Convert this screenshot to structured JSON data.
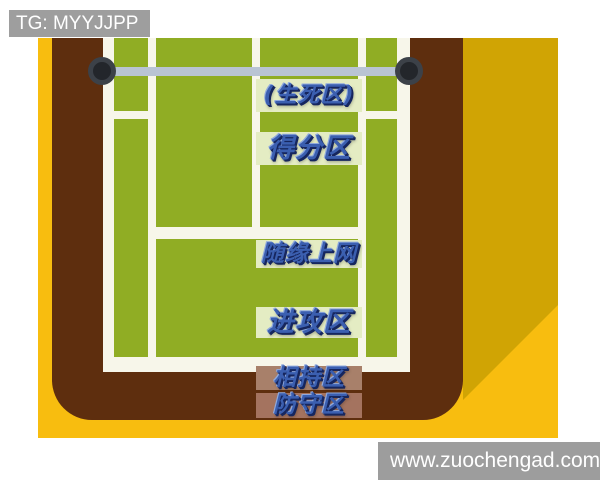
{
  "watermark": {
    "text": "TG: MYYJJPP"
  },
  "court": {
    "description": "tennis-court-zones-diagram",
    "zones": [
      {
        "name": "life-death-zone",
        "label": "(生死区)"
      },
      {
        "name": "scoring-zone",
        "label": "得分区"
      },
      {
        "name": "approach-net-zone",
        "label": "随缘上网"
      },
      {
        "name": "attack-zone",
        "label": "进攻区"
      },
      {
        "name": "rally-zone",
        "label": "相持区"
      },
      {
        "name": "defense-zone",
        "label": "防守区"
      }
    ]
  },
  "footer": {
    "website": "www.zuochengad.com"
  },
  "colors": {
    "background_yellow": "#f8bd0f",
    "background_mustard": "#d0a404",
    "court_surround_brown": "#5e2e0e",
    "court_green": "#90ad24",
    "court_lines_white": "#f7f6ea",
    "net_gray_blue": "#b9c4d3",
    "net_post_dark": "#23262b",
    "label_highlight_green": "#e4ecc3",
    "label_highlight_tan": "#a8806a",
    "label_highlight_rust": "#a4735f",
    "zone_text_blue": "#3b5fb0",
    "watermark_gray": "#9e9e9e"
  }
}
